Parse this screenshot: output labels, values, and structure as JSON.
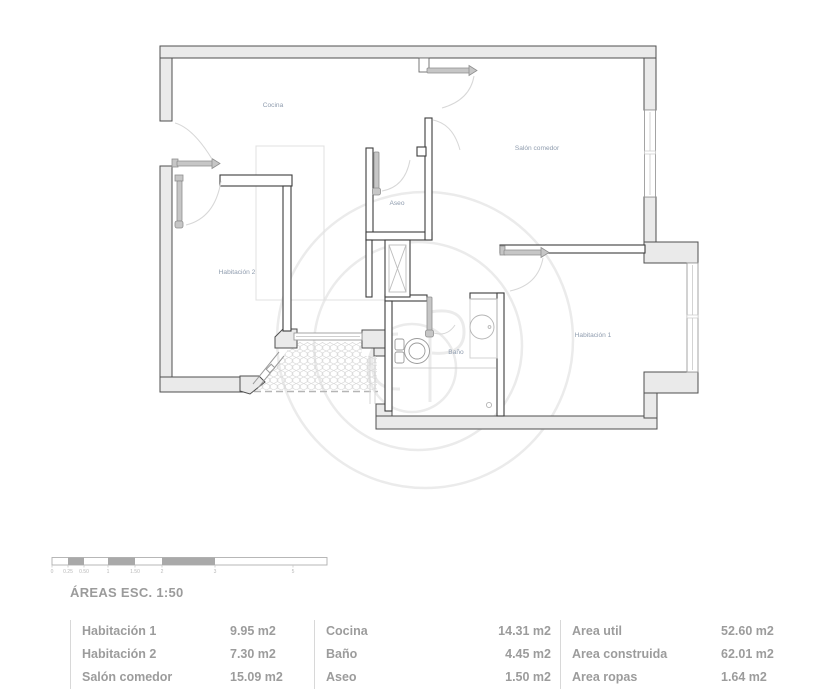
{
  "plan": {
    "rooms": [
      {
        "name": "Cocina"
      },
      {
        "name": "Salón comedor"
      },
      {
        "name": "Aseo"
      },
      {
        "name": "Habitación 2"
      },
      {
        "name": "Baño"
      },
      {
        "name": "Habitación 1"
      }
    ]
  },
  "scalebar": {
    "ticks": [
      "0",
      "0.25",
      "0.50",
      "1",
      "1.50",
      "2",
      "3",
      "5"
    ]
  },
  "areas": {
    "title": "ÁREAS ESC. 1:50",
    "groups": [
      {
        "rows": [
          {
            "label": "Habitación 1",
            "value": "9.95 m2"
          },
          {
            "label": "Habitación 2",
            "value": "7.30 m2"
          },
          {
            "label": "Salón comedor",
            "value": "15.09 m2"
          }
        ]
      },
      {
        "rows": [
          {
            "label": "Cocina",
            "value": "14.31 m2"
          },
          {
            "label": "Baño",
            "value": "4.45 m2"
          },
          {
            "label": "Aseo",
            "value": "1.50 m2"
          }
        ]
      },
      {
        "rows": [
          {
            "label": "Area util",
            "value": "52.60 m2"
          },
          {
            "label": "Area construida",
            "value": "62.01 m2"
          },
          {
            "label": "Area ropas",
            "value": "1.64 m2"
          }
        ]
      }
    ]
  },
  "colors": {
    "wall_fill": "#eaeaea",
    "wall_line": "#4f4f4f",
    "room_label": "#8f9cae",
    "table_text": "#9c9c9c",
    "watermark": "#ebebeb"
  }
}
